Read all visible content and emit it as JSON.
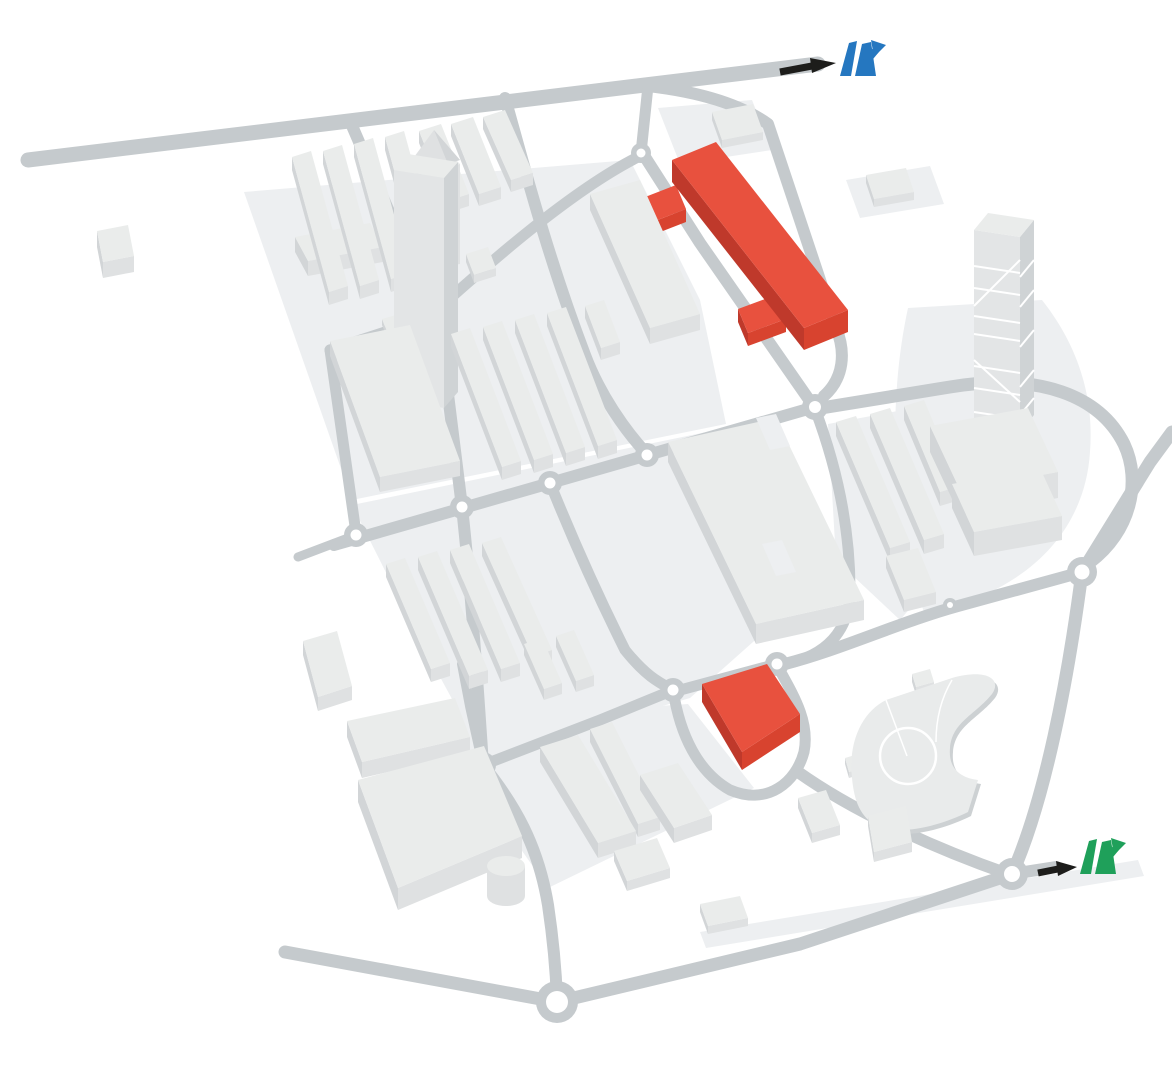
{
  "map": {
    "description": "Isometric campus area map with gray road network, light building blocks, two red highlighted buildings and two motorway junction markers reached by black arrows",
    "colors": {
      "background": "#ffffff",
      "road": "#c5cacd",
      "parcel": "#edeff1",
      "building_top": "#eaeceb",
      "building_front": "#dfe1e2",
      "building_side": "#d2d5d7",
      "tower_face_light": "#e3e5e6",
      "tower_face_dark": "#cfd3d5",
      "plate": "#e9ebeb",
      "plate_shadow": "#cdd1d3",
      "stripe": "#ffffff",
      "highlight_top": "#e8513e",
      "highlight_front": "#d8432f",
      "highlight_side": "#bf392b",
      "arrow": "#1d1d1b",
      "motorway_blue": "#2577c0",
      "motorway_green": "#1fa05a"
    },
    "highlighted_buildings": [
      {
        "id": "highlight-building-north",
        "shape": "elongated-slab-with-two-wings"
      },
      {
        "id": "highlight-building-south",
        "shape": "quad-block"
      }
    ],
    "markers": [
      {
        "id": "motorway-junction-blue",
        "icon": "motorway-junction-icon",
        "color_key": "motorway_blue",
        "position": "top-right",
        "arrow": "black-arrow-pointing-right"
      },
      {
        "id": "motorway-junction-green",
        "icon": "motorway-junction-icon",
        "color_key": "motorway_green",
        "position": "bottom-right",
        "arrow": "black-arrow-pointing-right"
      }
    ],
    "roundabout_count": 13
  }
}
